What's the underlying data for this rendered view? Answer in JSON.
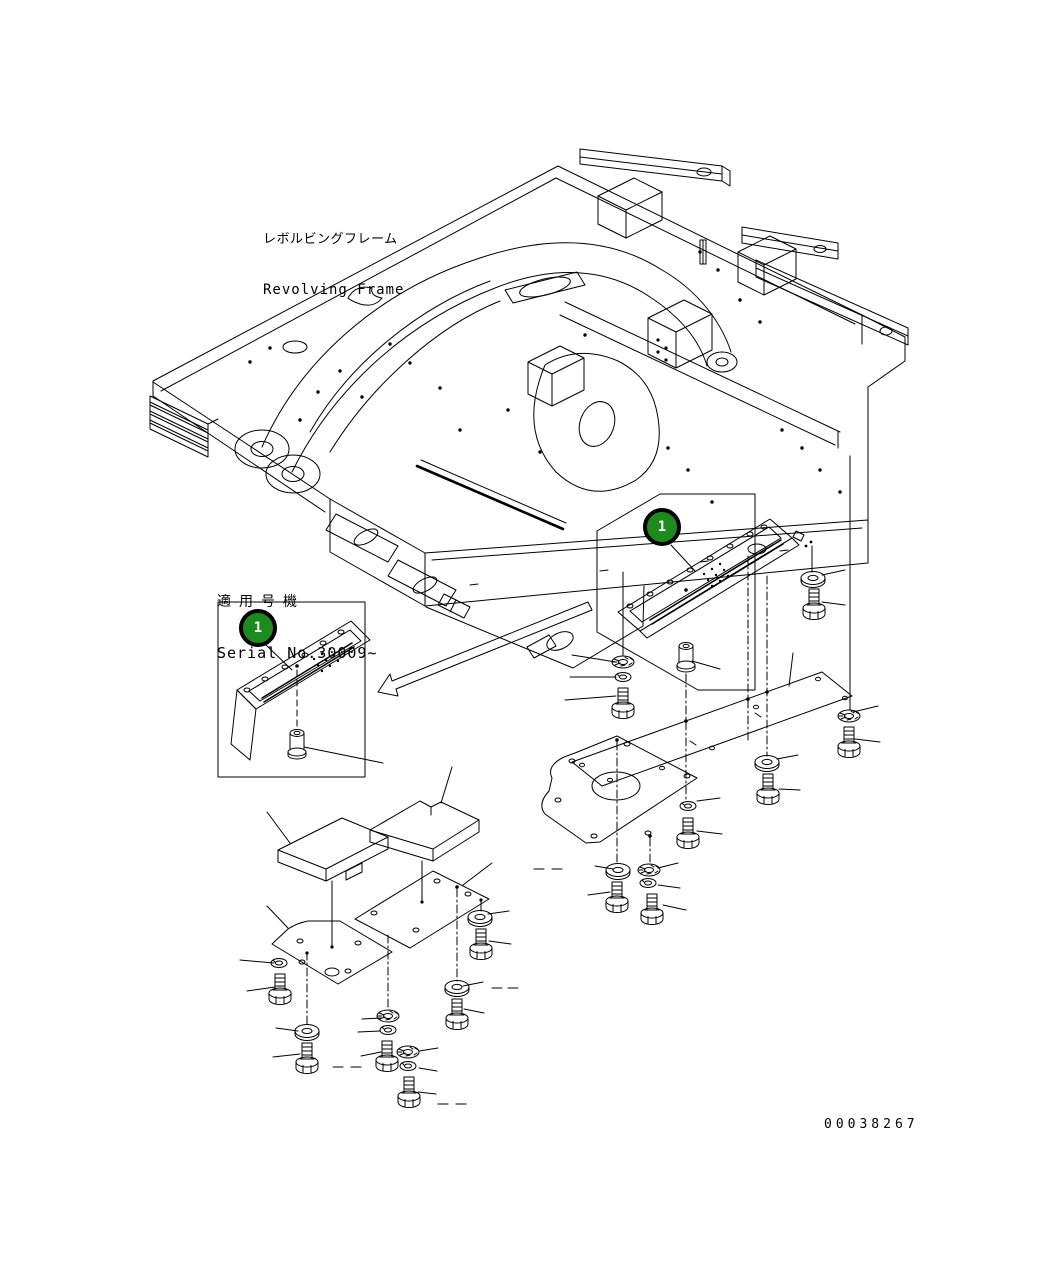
{
  "document": {
    "kind": "parts-diagram",
    "drawing_number": "00038267"
  },
  "labels": {
    "frame_jp": "レボルビングフレーム",
    "frame_en": "Revolving Frame",
    "serial_jp": "適用号機",
    "serial_en": "Serial No.30009~"
  },
  "callouts": {
    "left_balloon": "1",
    "right_balloon": "1"
  },
  "colors": {
    "line": "#000000",
    "background": "#ffffff",
    "balloon_fill": "#1d8a1d",
    "balloon_ring": "#000000",
    "balloon_text": "#ffffff"
  }
}
